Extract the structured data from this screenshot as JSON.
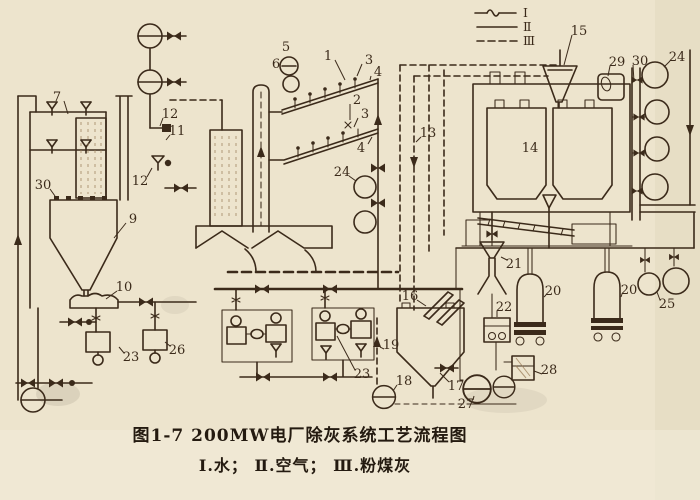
{
  "figure": {
    "caption_title": "图1-7  200MW电厂除灰系统工艺流程图",
    "caption_legend": "Ⅰ.水； Ⅱ.空气； Ⅲ.粉煤灰"
  },
  "legend": {
    "items": [
      {
        "numeral": "Ⅰ",
        "meaning": "水",
        "line_style": "solid-with-tilde"
      },
      {
        "numeral": "Ⅱ",
        "meaning": "空气",
        "line_style": "solid"
      },
      {
        "numeral": "Ⅲ",
        "meaning": "粉煤灰",
        "line_style": "dashed"
      }
    ]
  },
  "colors": {
    "paper": "#ede4cd",
    "ink": "#3b2a1a"
  },
  "callouts": [
    {
      "t": "1",
      "x": 328,
      "y": 56,
      "lx": 345,
      "ly": 80
    },
    {
      "t": "3",
      "x": 369,
      "y": 60,
      "lx": 357,
      "ly": 76
    },
    {
      "t": "4",
      "x": 378,
      "y": 72,
      "lx": 370,
      "ly": 80
    },
    {
      "t": "2",
      "x": 357,
      "y": 100,
      "lx": 350,
      "ly": 120
    },
    {
      "t": "3",
      "x": 365,
      "y": 114,
      "lx": 354,
      "ly": 127
    },
    {
      "t": "4",
      "x": 361,
      "y": 148,
      "lx": 372,
      "ly": 137
    },
    {
      "t": "5",
      "x": 286,
      "y": 47
    },
    {
      "t": "6",
      "x": 276,
      "y": 64
    },
    {
      "t": "7",
      "x": 57,
      "y": 97,
      "lx": 68,
      "ly": 114
    },
    {
      "t": "9",
      "x": 133,
      "y": 219,
      "lx": 114,
      "ly": 238
    },
    {
      "t": "10",
      "x": 124,
      "y": 287,
      "lx": 106,
      "ly": 299
    },
    {
      "t": "11",
      "x": 177,
      "y": 131,
      "lx": 166,
      "ly": 140
    },
    {
      "t": "12",
      "x": 170,
      "y": 114,
      "lx": 160,
      "ly": 126
    },
    {
      "t": "12",
      "x": 140,
      "y": 181,
      "lx": 152,
      "ly": 168
    },
    {
      "t": "13",
      "x": 428,
      "y": 133,
      "lx": 416,
      "ly": 142
    },
    {
      "t": "14",
      "x": 530,
      "y": 148
    },
    {
      "t": "15",
      "x": 579,
      "y": 31,
      "lx": 564,
      "ly": 65
    },
    {
      "t": "16",
      "x": 410,
      "y": 296,
      "lx": 426,
      "ly": 306
    },
    {
      "t": "17",
      "x": 456,
      "y": 386,
      "lx": 440,
      "ly": 373
    },
    {
      "t": "18",
      "x": 404,
      "y": 381,
      "lx": 393,
      "ly": 391
    },
    {
      "t": "19",
      "x": 391,
      "y": 345,
      "lx": 380,
      "ly": 347
    },
    {
      "t": "20",
      "x": 553,
      "y": 291,
      "lx": 544,
      "ly": 297
    },
    {
      "t": "20",
      "x": 629,
      "y": 290,
      "lx": 621,
      "ly": 297
    },
    {
      "t": "21",
      "x": 514,
      "y": 264,
      "lx": 501,
      "ly": 257
    },
    {
      "t": "22",
      "x": 504,
      "y": 307,
      "lx": 497,
      "ly": 317
    },
    {
      "t": "23",
      "x": 131,
      "y": 357,
      "lx": 119,
      "ly": 347
    },
    {
      "t": "23",
      "x": 362,
      "y": 374,
      "lx": 337,
      "ly": 336
    },
    {
      "t": "24",
      "x": 342,
      "y": 172,
      "lx": 356,
      "ly": 181
    },
    {
      "t": "24",
      "x": 677,
      "y": 57,
      "lx": 664,
      "ly": 67
    },
    {
      "t": "25",
      "x": 667,
      "y": 304,
      "lx": 657,
      "ly": 292
    },
    {
      "t": "26",
      "x": 177,
      "y": 350,
      "lx": 165,
      "ly": 342
    },
    {
      "t": "27",
      "x": 466,
      "y": 404,
      "lx": 474,
      "ly": 396
    },
    {
      "t": "28",
      "x": 549,
      "y": 370,
      "lx": 534,
      "ly": 371
    },
    {
      "t": "29",
      "x": 617,
      "y": 62,
      "lx": 608,
      "ly": 76
    },
    {
      "t": "30",
      "x": 43,
      "y": 185,
      "lx": 55,
      "ly": 196
    },
    {
      "t": "30",
      "x": 640,
      "y": 61,
      "lx": 634,
      "ly": 82
    }
  ]
}
